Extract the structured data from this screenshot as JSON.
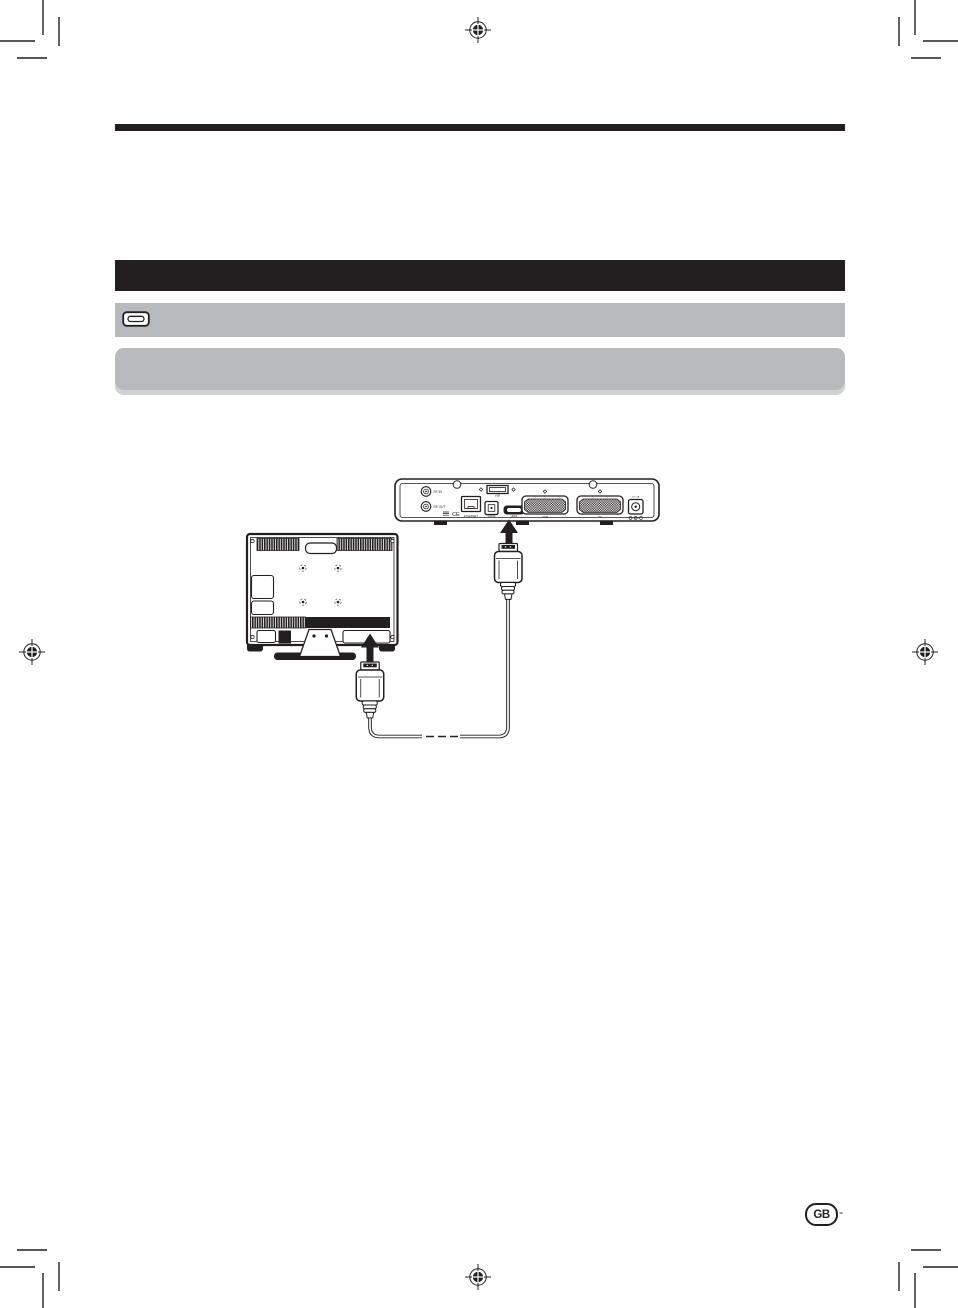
{
  "page": {
    "country_badge": "GB",
    "page_number_dash": "-"
  },
  "diagram": {
    "description_labels": {
      "rf_in": "RF IN",
      "rf_out": "RF OUT",
      "ce_mark": "CE",
      "ethernet": "ETHERNET",
      "usb": "USB",
      "spdif": "S/PDIF",
      "hdmi": "HDMI",
      "vcr_scart": "VCR",
      "tv_scart": "TV",
      "power": "12V 2A"
    }
  },
  "colors": {
    "print_black": "#231f20",
    "bar_gray": "#b9babe"
  }
}
